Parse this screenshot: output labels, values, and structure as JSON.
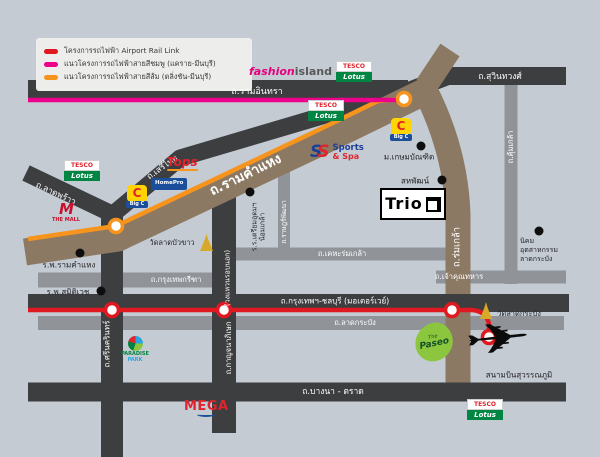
{
  "legend": {
    "items": [
      {
        "color": "#e0181f",
        "label": "โครงการรถไฟฟ้า Airport Rail Link"
      },
      {
        "color": "#ec008c",
        "label": "แนวโครงการรถไฟฟ้าสายสีชมพู (แคราย-มีนบุรี)"
      },
      {
        "color": "#f7941d",
        "label": "แนวโครงการรถไฟฟ้าสายสีส้ม (ตลิ่งชัน-มีนบุรี)"
      }
    ]
  },
  "colors": {
    "pink_line": "#ec008c",
    "orange_line": "#f7941d",
    "red_line": "#e0181f",
    "dark_road": "#3d3e40",
    "gray_road": "#909499",
    "brown_road": "#8c7963"
  },
  "roads": {
    "ramintra": "ถ.รามอินทรา",
    "suwinthawong": "ถ.สุวินทวงศ์",
    "serithai": "ถ.เสรีไทย",
    "latphrao": "ถ.ลาดพร้าว",
    "ramkhamhaeng": "ถ.รามคำแหง",
    "romklao": "ถ.ร่มเกล้า",
    "khumklao": "ถ.คุ้มเกล้า",
    "ratphatthana": "ถ.ราษฎร์พัฒนา",
    "kanchanaphisek": "ถ.กาญจนาภิเษก",
    "kanchanaphisek_sub": "(วงแหวนรอบนอก)",
    "srinakarin": "ถ.ศรีนครินทร์",
    "krungthep_kreetha": "ถ.กรุงเทพกรีฑา",
    "kheha_romklao": "ถ.เคหะร่มเกล้า",
    "motorway": "ถ.กรุงเทพฯ-ชลบุรี (มอเตอร์เวย์)",
    "lat_krabang": "ถ.ลาดกระบัง",
    "chao_khun_thahan": "ถ.เจ้าคุณทหาร",
    "bangna_trat": "ถ.บางนา - ตราด"
  },
  "places": {
    "kasem_bundit": "ม.เกษมบัณฑิต",
    "sahapat": "สหพัฒน์",
    "nikhom_line1": "นิคม",
    "nikhom_line2": "อุตสาหกรรม",
    "nikhom_line3": "ลาดกระบัง",
    "triam_udom": "ร.ร.เตรียมอุดมฯ น้อมเกล้า",
    "wat_lad_bua_khaw": "วัดลาดบัวขาว",
    "wat_lat_krabang": "วัดลาดกระบัง",
    "ram_hospital": "ร.พ.รามคำแหง",
    "samitivej_hospital": "ร.พ.สมิติเวช",
    "airport": "สนามบินสุวรรณภูมิ"
  },
  "logos": {
    "fashion_island_1": "fashion",
    "fashion_island_2": "island",
    "tesco_top": "TESCO",
    "tesco_bottom": "Lotus",
    "tops": "Tops",
    "homepro": "HomePro",
    "bigc_letter": "C",
    "bigc_text": "Big C",
    "the_mall_m": "M",
    "the_mall_text": "THE MALL",
    "sports_s1": "S",
    "sports_s2": "S",
    "sports_line1": "Sports",
    "sports_line2": "& Spa",
    "trio": "Trio",
    "paradise_line1": "PARADISE",
    "paradise_line2": "PARK",
    "mega": "MEGA",
    "paseo_the": "The",
    "paseo_name": "Paseo",
    "plane_glyph": "✈"
  }
}
